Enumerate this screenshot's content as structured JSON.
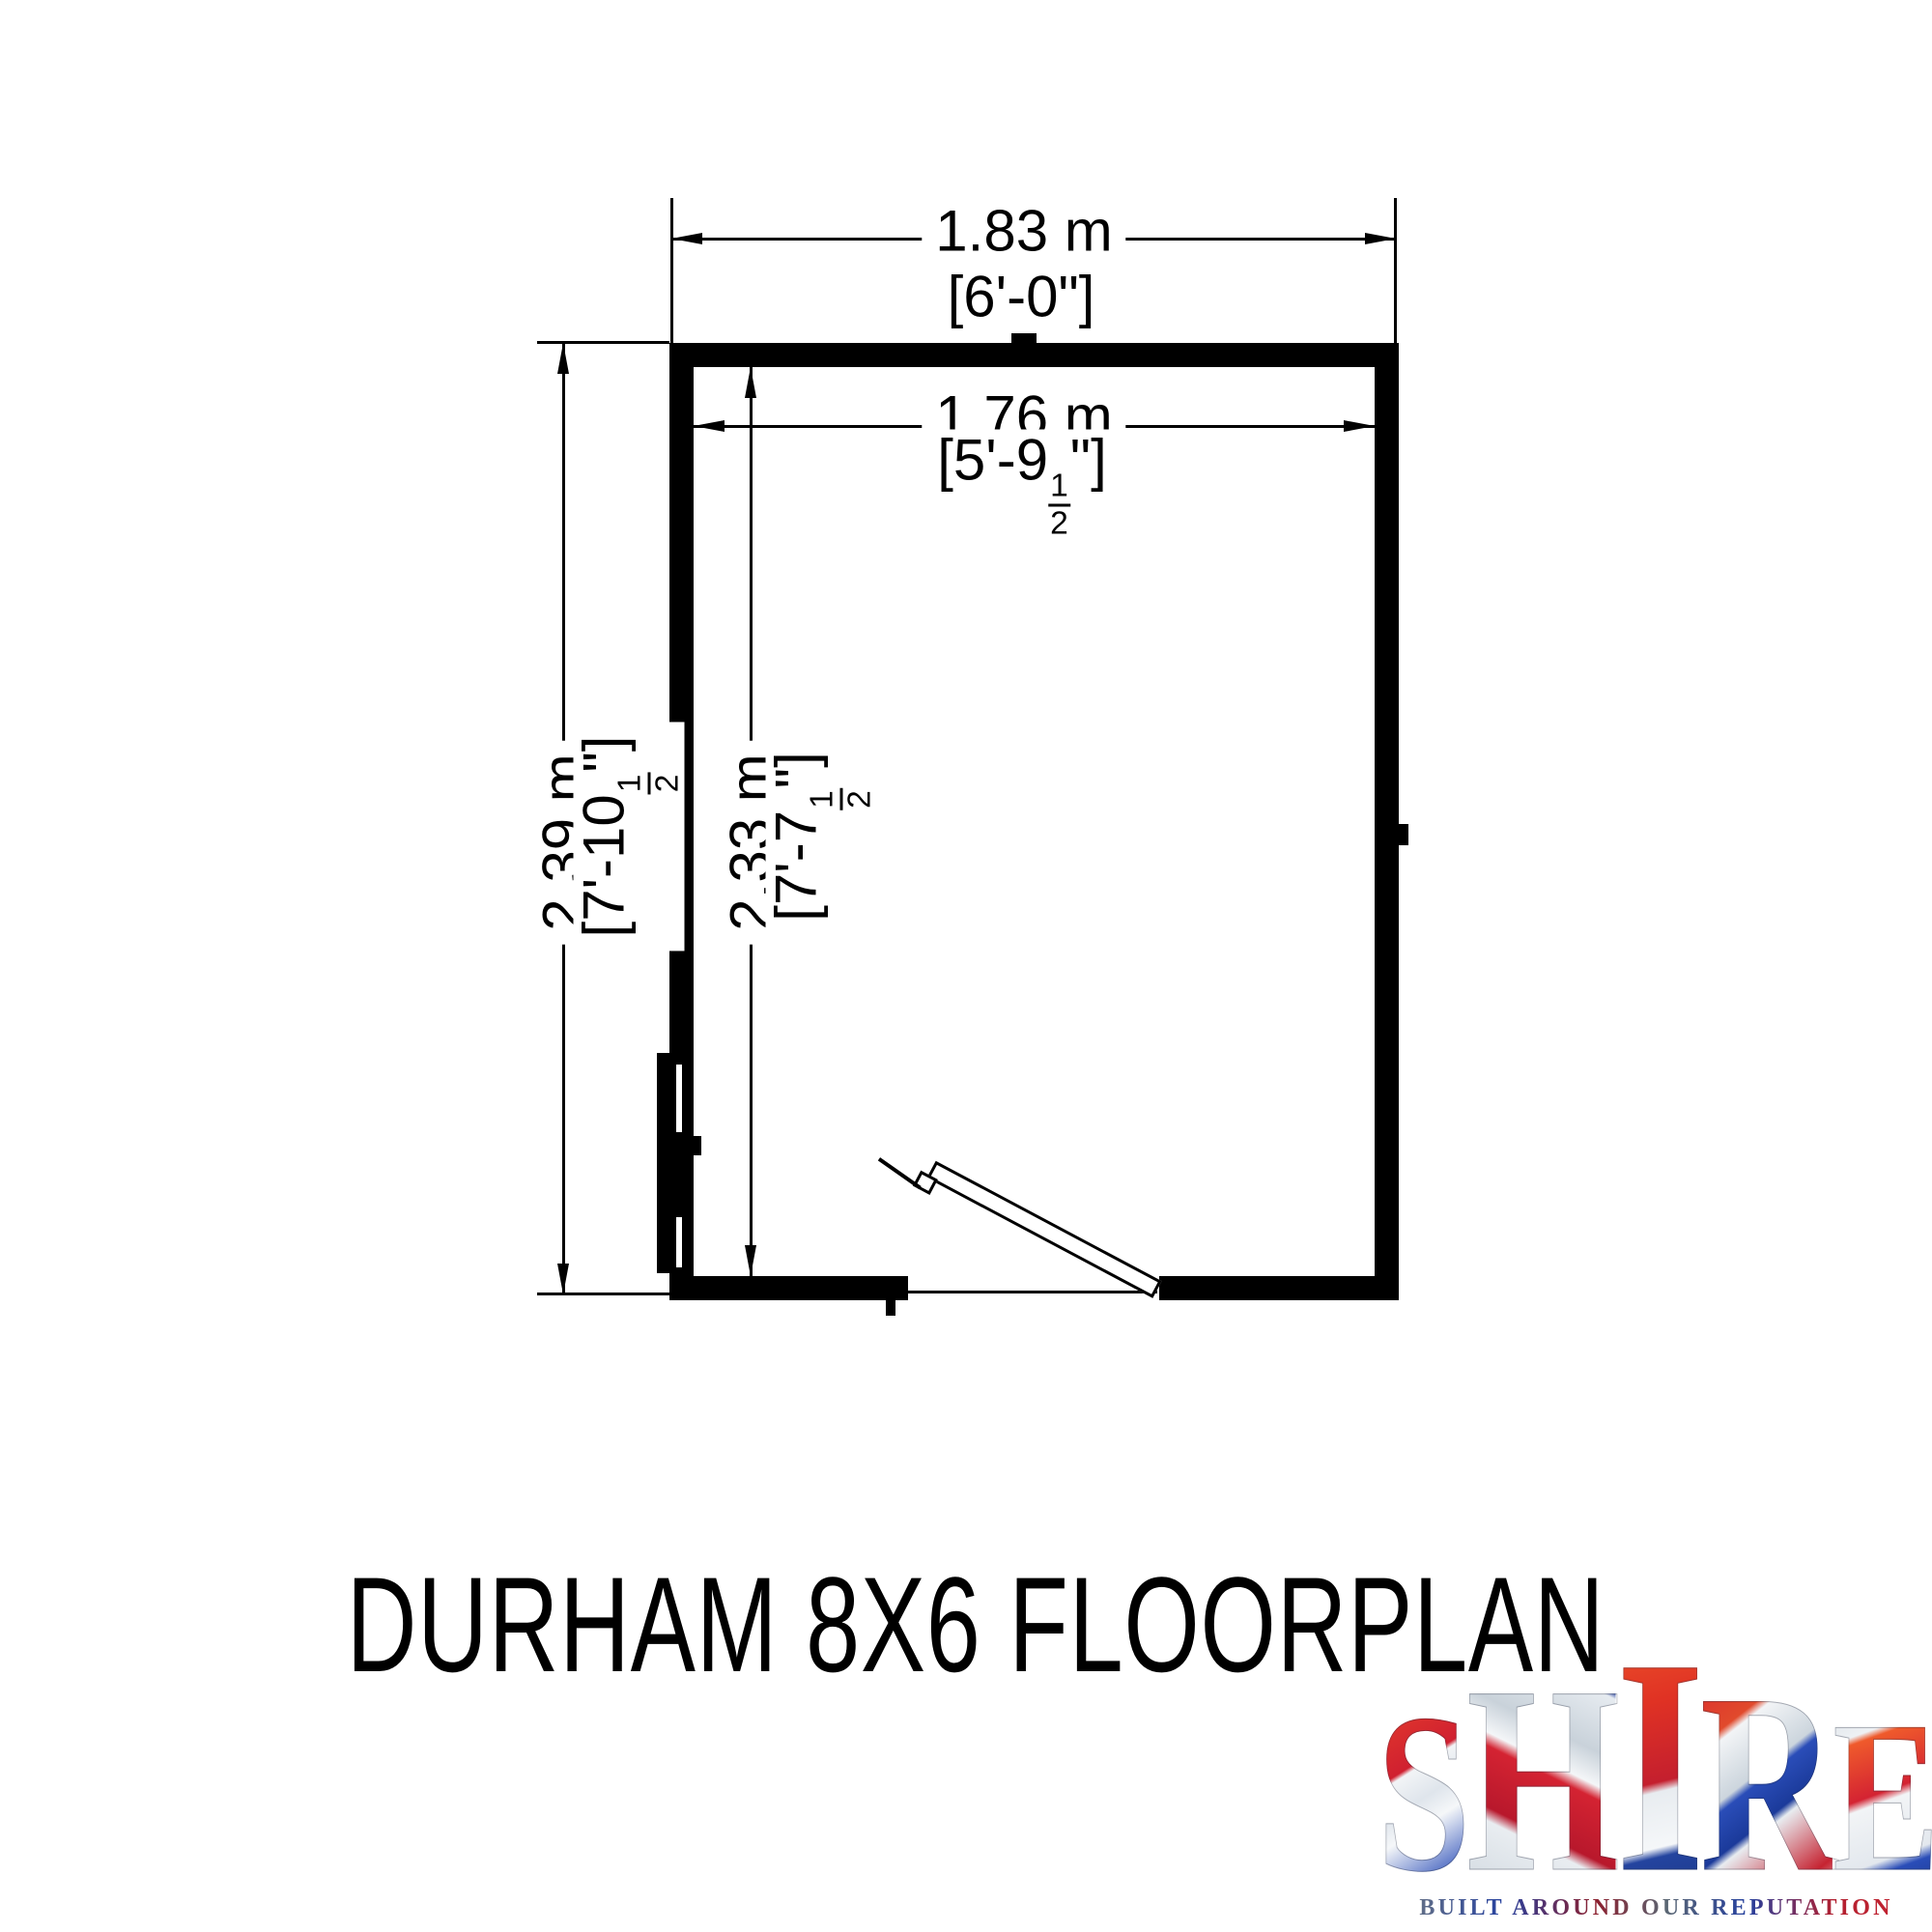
{
  "floorplan": {
    "title": "DURHAM 8X6 FLOORPLAN",
    "dims": {
      "width_outer": {
        "metric": "1.83 m",
        "imperial": "[6'-0\"]"
      },
      "width_inner": {
        "metric": "1.76 m",
        "imperial_prefix": "[5'-9",
        "frac_num": "1",
        "frac_den": "2",
        "imperial_suffix": "\"]"
      },
      "height_outer": {
        "metric": "2.39 m",
        "imperial_prefix": "[7'-10",
        "frac_num": "1",
        "frac_den": "2",
        "imperial_suffix": "\"]"
      },
      "height_inner": {
        "metric": "2.33 m",
        "imperial_prefix": "[7'-7",
        "frac_num": "1",
        "frac_den": "2",
        "imperial_suffix": "\"]"
      }
    }
  },
  "logo": {
    "brand_letters": [
      "S",
      "H",
      "I",
      "R",
      "E"
    ],
    "tagline": "BUILT AROUND OUR REPUTATION",
    "colors": {
      "red": "#cf1b2b",
      "blue": "#1f3d99",
      "silver": "#c9d2da",
      "white": "#f5f7f9"
    }
  },
  "colors": {
    "ink": "#000000",
    "paper": "#ffffff"
  }
}
